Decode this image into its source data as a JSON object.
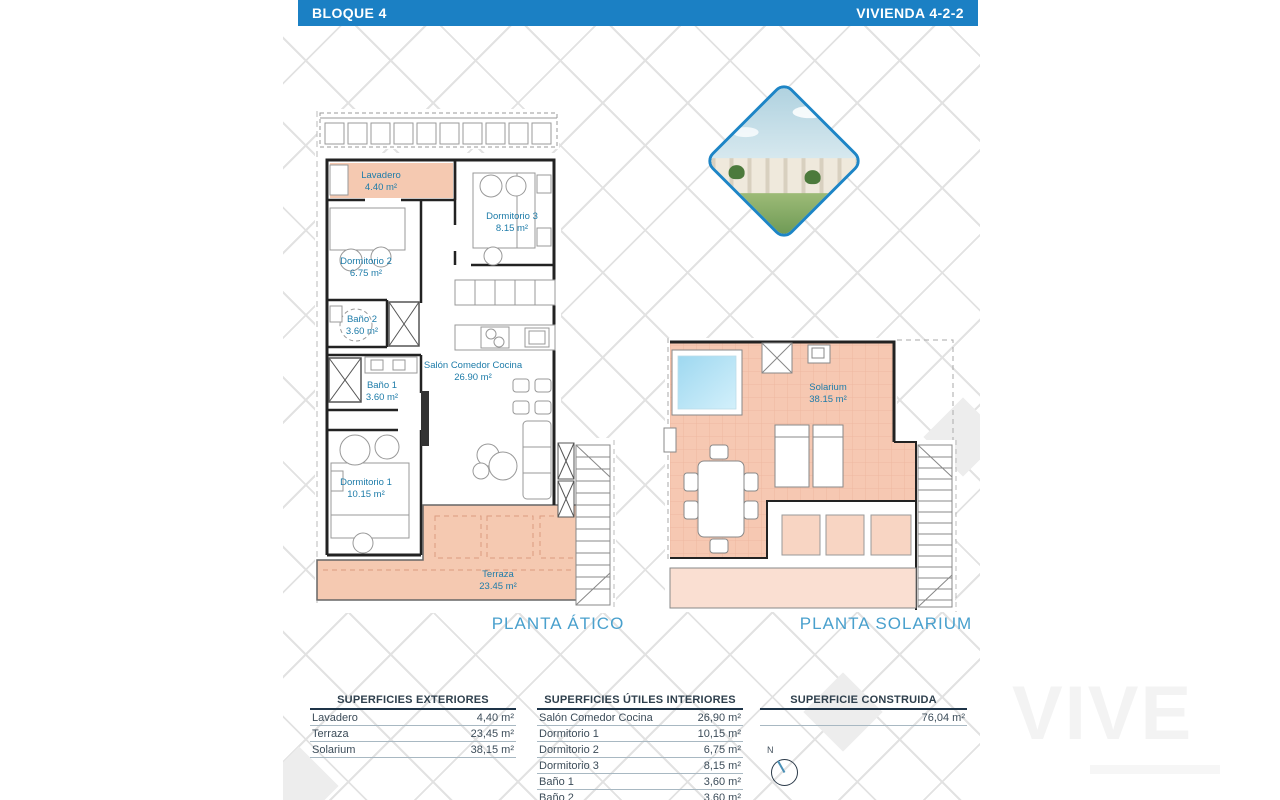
{
  "header": {
    "left_title": "BLOQUE 4",
    "right_title": "VIVIENDA 4-2-2"
  },
  "plans": [
    {
      "title": "PLANTA ÁTICO",
      "rooms": [
        {
          "name": "Lavadero",
          "area": "4.40 m²"
        },
        {
          "name": "Dormitorio 3",
          "area": "8.15 m²"
        },
        {
          "name": "Dormitorio 2",
          "area": "6.75 m²"
        },
        {
          "name": "Baño 2",
          "area": "3.60 m²"
        },
        {
          "name": "Baño 1",
          "area": "3.60 m²"
        },
        {
          "name": "Salón Comedor Cocina",
          "area": "26.90 m²"
        },
        {
          "name": "Dormitorio 1",
          "area": "10.15 m²"
        },
        {
          "name": "Terraza",
          "area": "23.45 m²"
        }
      ]
    },
    {
      "title": "PLANTA SOLARIUM",
      "rooms": [
        {
          "name": "Solarium",
          "area": "38.15 m²"
        }
      ]
    }
  ],
  "tables": [
    {
      "title": "SUPERFICIES EXTERIORES",
      "rows": [
        [
          "Lavadero",
          "4,40 m²"
        ],
        [
          "Terraza",
          "23,45 m²"
        ],
        [
          "Solarium",
          "38,15 m²"
        ]
      ]
    },
    {
      "title": "SUPERFICIES ÚTILES INTERIORES",
      "rows": [
        [
          "Salón Comedor Cocina",
          "26,90 m²"
        ],
        [
          "Dormitorio 1",
          "10,15 m²"
        ],
        [
          "Dormitorio 2",
          "6,75 m²"
        ],
        [
          "Dormitorio 3",
          "8,15 m²"
        ],
        [
          "Baño 1",
          "3,60 m²"
        ],
        [
          "Baño 2",
          "3,60 m²"
        ]
      ]
    },
    {
      "title": "SUPERFICIE CONSTRUIDA",
      "rows": [
        [
          "",
          "76,04 m²"
        ]
      ]
    }
  ],
  "compass": {
    "north_label": "N"
  },
  "watermark": {
    "text": "VIVE"
  },
  "colors": {
    "header_bar": "#1b80c4",
    "room_label": "#1e7ca9",
    "plan_title": "#49a0cd",
    "terrace_fill": "#f5c9b1",
    "solarium_fill": "#f6c8b2",
    "pool_fill": "#aadcf2",
    "table_header_line": "#1e3448"
  }
}
